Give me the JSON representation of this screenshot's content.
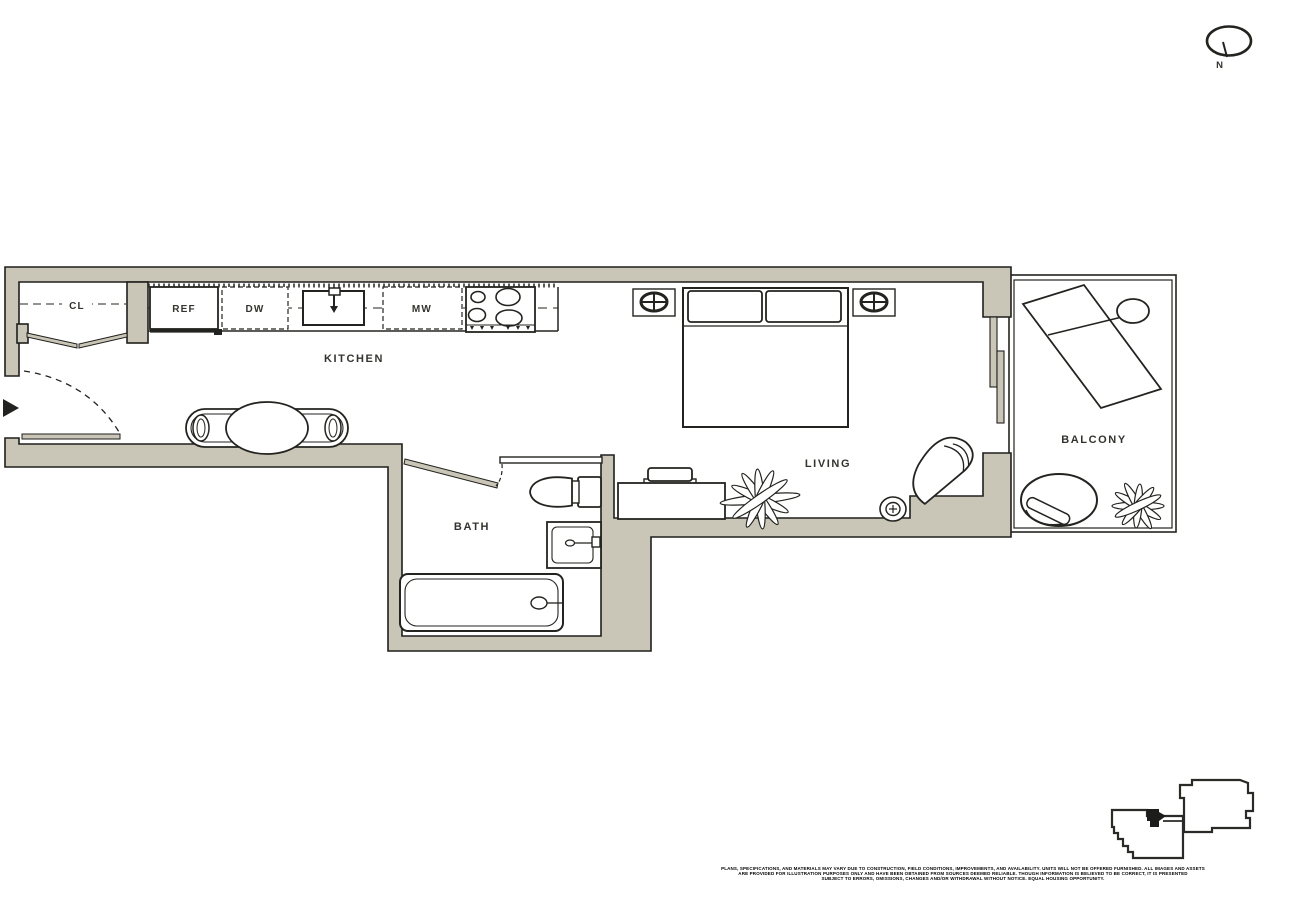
{
  "compass": {
    "label": "N"
  },
  "labels": {
    "kitchen": "KITCHEN",
    "living": "LIVING",
    "bath": "BATH",
    "balcony": "BALCONY",
    "closet": "CL",
    "refrigerator": "REF",
    "dishwasher": "DW",
    "microwave": "MW"
  },
  "colors": {
    "wall_fill": "#CAC6B7",
    "line": "#23231F",
    "background": "#FFFFFF"
  },
  "disclaimer": {
    "line1": "PLANS, SPECIFICATIONS, AND MATERIALS MAY VARY DUE TO CONSTRUCTION, FIELD CONDITIONS, IMPROVEMENTS, AND AVAILABILITY. UNITS WILL NOT BE OFFERED FURNISHED. ALL IMAGES AND ASSETS",
    "line2": "ARE PROVIDED FOR ILLUSTRATION PURPOSES ONLY AND HAVE BEEN OBTAINED FROM SOURCES DEEMED RELIABLE. THOUGH INFORMATION IS BELIEVED TO BE CORRECT, IT IS PRESENTED",
    "line3": "SUBJECT TO ERRORS, OMISSIONS, CHANGES AND/OR WITHDRAWAL WITHOUT NOTICE. EQUAL HOUSING OPPORTUNITY."
  }
}
